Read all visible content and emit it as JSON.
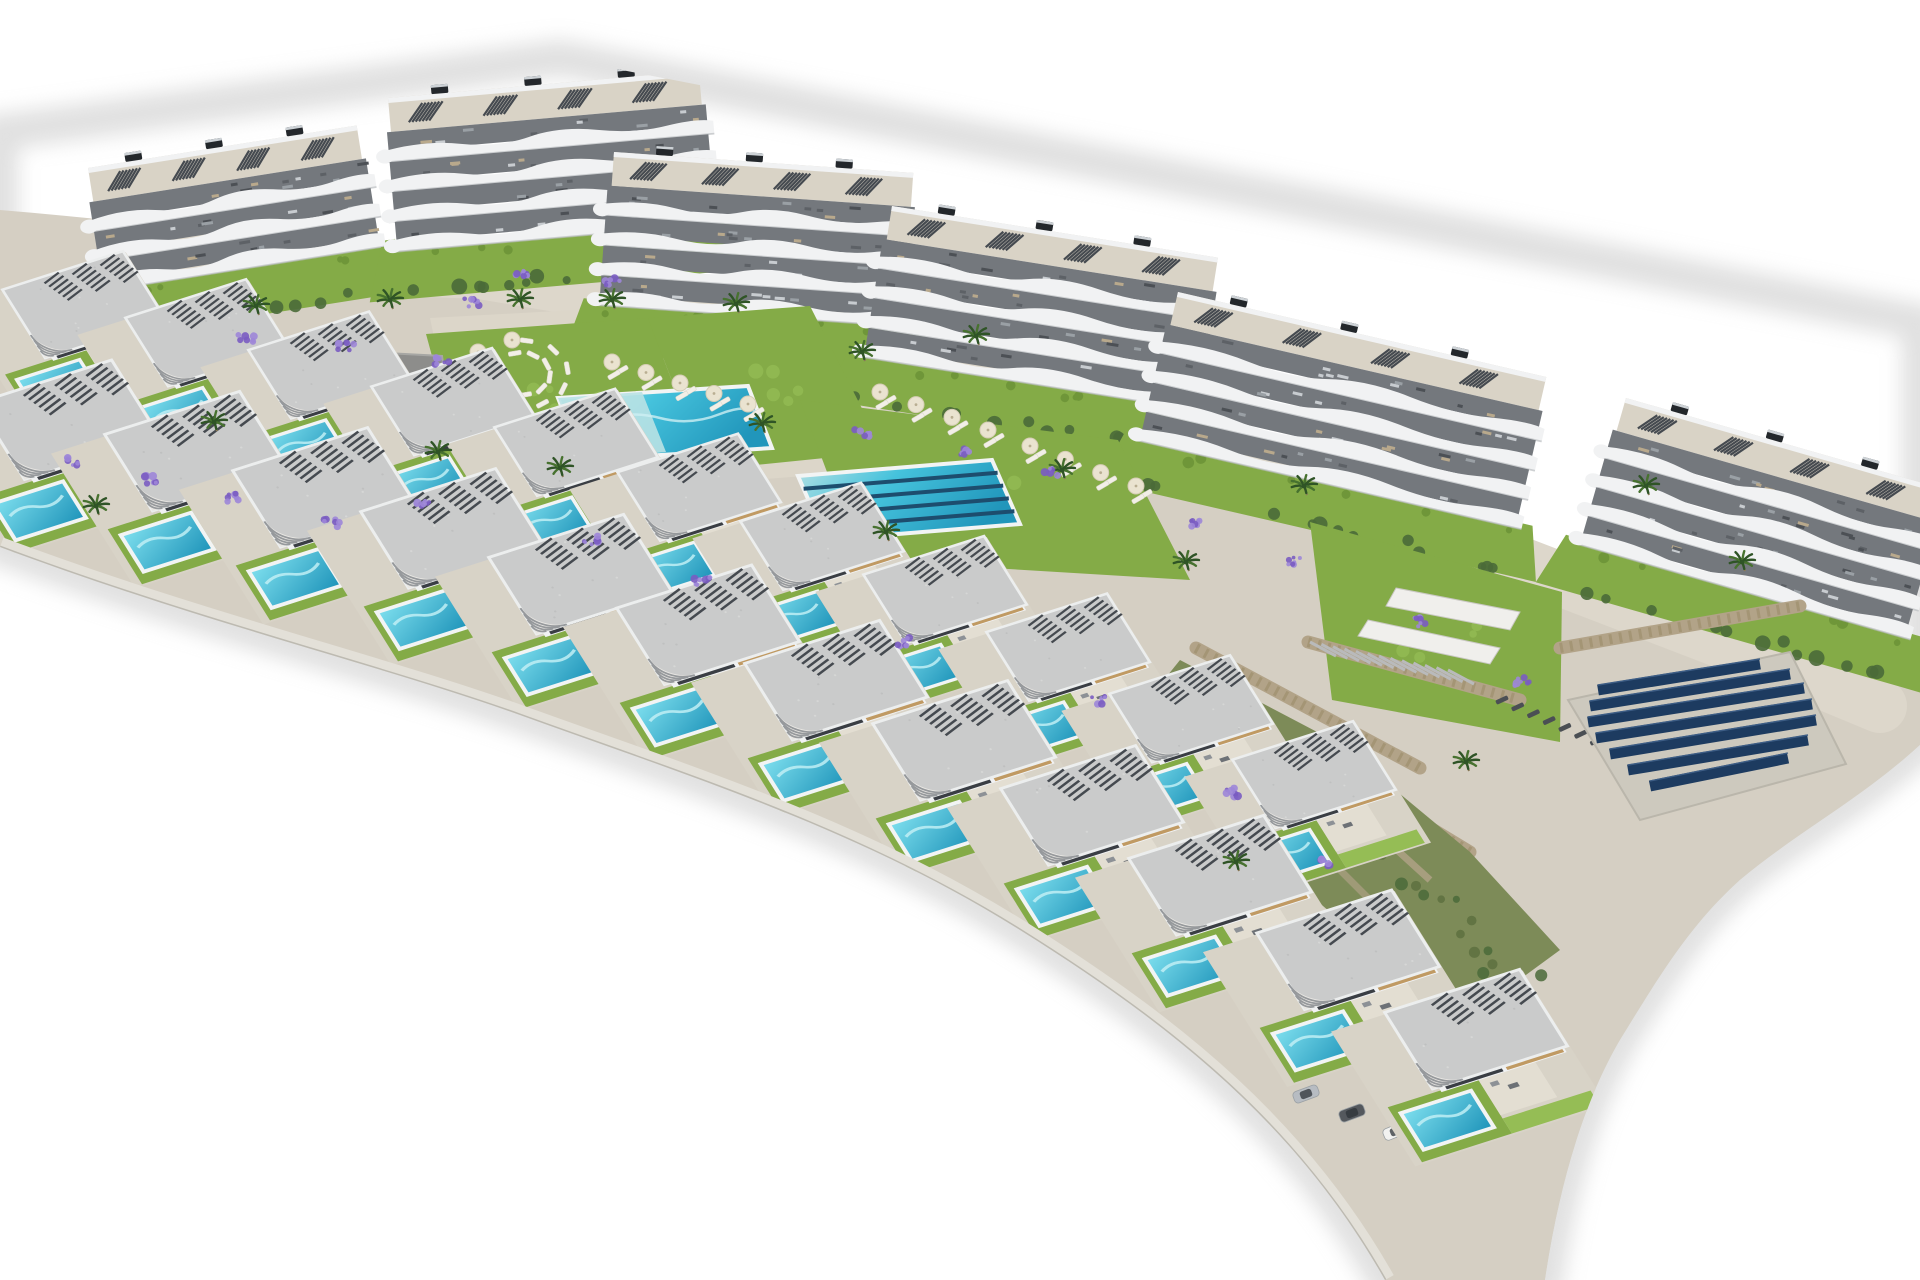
{
  "scene": {
    "alt_text": "Aerial 3D render of a hillside residential development: a curved row of six white terraced apartment blocks behind communal gardens with two turquoise pools, two stepped rows of modern villas each with a private pool, a playground, palm trees, lavender beds, stone retaining walls and a solar panel array, all on a white background",
    "counts": {
      "apartment_blocks": 6,
      "back_row_villas": 11,
      "front_row_villas": 12,
      "communal_pools": 2,
      "solar_panel_rows": 7,
      "cars": 7,
      "palm_trees": 20,
      "lavender_clusters": 24
    },
    "colors": {
      "bg": "#ffffff",
      "ground": "#d5cfc3",
      "promenade": "#ddd7cb",
      "sand": "#dcd6c9",
      "road": "#d2cec5",
      "lawn": "#84ab47",
      "lawn_light": "#95bd55",
      "lawn_dark": "#6f9639",
      "hedge": "#4a6a39",
      "pool_shallow": "#b9e2e4",
      "pool_mid": "#45c2dc",
      "pool_deep": "#2196bb",
      "pool_rim": "#f2f4f4",
      "lane": "#1d4d6e",
      "stone": "#b2a388",
      "stone_dark": "#93845f",
      "roof": "#cacbcb",
      "roof_fascia": "#e9e7e3",
      "slat": "#454a50",
      "beige": "#c09a63",
      "opening": "#3a3e44",
      "facade": "#f1f2f3",
      "balcony": "#74787d",
      "deck": "#d9d3c6",
      "solar": "#1d3b60",
      "solar_pad": "#cdc9be",
      "playground_pad": "#8d8d8b",
      "purple": "#7a5cc2",
      "purple_light": "#9d86d8",
      "palm": "#47722f",
      "palm_dark": "#2f5426",
      "trunk": "#8a7a58",
      "shadow": "#c2c2c2",
      "umbrella": "#eae3d0",
      "lounger": "#f2efe7",
      "lounger_dark": "#4b4f54"
    },
    "geometry": {
      "outline": "M0,132 L560,58 L1920,322 L1920,745 C1860,800 1800,830 1740,880 C1690,925 1660,975 1620,1040 C1585,1100 1560,1180 1545,1280 L1385,1280 C1300,1130 1180,1030 1020,930 C860,830 700,780 520,715 C380,665 200,622 0,547 Z",
      "ground_top": "M0,210 C350,240 700,295 1050,380 C1250,430 1450,510 1600,565 C1700,600 1850,640 1920,660 L1920,745 C1860,800 1800,830 1740,880 C1690,925 1660,975 1620,1040 C1585,1100 1560,1180 1545,1280 L1385,1280 C1300,1130 1180,1030 1020,930 C860,830 700,780 520,715 C380,665 200,622 0,547 Z",
      "bottom_edge": "M0,547 C200,622 380,665 520,715 C700,780 860,830 1020,930 C1180,1030 1300,1130 1385,1280",
      "promenade_pts": [
        [
          140,
          258
        ],
        [
          480,
          272
        ],
        [
          860,
          336
        ],
        [
          1200,
          438
        ],
        [
          1500,
          556
        ],
        [
          1740,
          648
        ],
        [
          1880,
          706
        ]
      ],
      "sand_pad": [
        [
          430,
          318
        ],
        [
          828,
          296
        ],
        [
          908,
          468
        ],
        [
          468,
          502
        ]
      ],
      "blocks": [
        {
          "x": 88,
          "y": 168,
          "w": 272,
          "floors": 3,
          "angle": -9
        },
        {
          "x": 388,
          "y": 98,
          "w": 312,
          "floors": 4,
          "angle": -5
        },
        {
          "x": 614,
          "y": 152,
          "w": 300,
          "floors": 4,
          "angle": 4
        },
        {
          "x": 892,
          "y": 206,
          "w": 330,
          "floors": 4,
          "angle": 9
        },
        {
          "x": 1178,
          "y": 292,
          "w": 378,
          "floors": 4,
          "angle": 13
        },
        {
          "x": 1626,
          "y": 398,
          "w": 330,
          "floors": 4,
          "angle": 16
        }
      ],
      "villa_rows": [
        {
          "name": "back",
          "count": 11,
          "sx": -34,
          "sy": 312,
          "dx": 123,
          "dy": 26,
          "acc": 2.1,
          "scale": 0.93
        },
        {
          "name": "front",
          "count": 12,
          "sx": -64,
          "sy": 428,
          "dx": 128,
          "dy": 29,
          "acc": 2.4,
          "scale": 1.04
        }
      ],
      "pools": {
        "main": {
          "pts": [
            [
              558,
              398
            ],
            [
              748,
              386
            ],
            [
              772,
              448
            ],
            [
              582,
              460
            ]
          ],
          "shallow": [
            [
              558,
              398
            ],
            [
              642,
              392
            ],
            [
              666,
              452
            ],
            [
              582,
              460
            ]
          ]
        },
        "lap": {
          "pts": [
            [
              798,
              476
            ],
            [
              992,
              460
            ],
            [
              1020,
              524
            ],
            [
              826,
              540
            ]
          ],
          "lanes": 4
        }
      },
      "lawns": [
        [
          [
            426,
            334
          ],
          [
            648,
            318
          ],
          [
            706,
            470
          ],
          [
            470,
            496
          ]
        ],
        [
          [
            648,
            318
          ],
          [
            810,
            306
          ],
          [
            884,
            452
          ],
          [
            706,
            470
          ]
        ],
        [
          [
            800,
            400
          ],
          [
            1118,
            440
          ],
          [
            1190,
            580
          ],
          [
            860,
            560
          ]
        ],
        [
          [
            1310,
            522
          ],
          [
            1562,
            592
          ],
          [
            1560,
            742
          ],
          [
            1332,
            700
          ]
        ],
        [
          [
            58,
            382
          ],
          [
            252,
            420
          ],
          [
            236,
            472
          ],
          [
            58,
            440
          ]
        ]
      ],
      "walls": [
        [
          [
            0,
            338
          ],
          [
            240,
            392
          ],
          [
            500,
            464
          ],
          [
            762,
            548
          ],
          [
            1022,
            644
          ],
          [
            1232,
            742
          ]
        ],
        [
          [
            60,
            472
          ],
          [
            350,
            522
          ],
          [
            700,
            588
          ],
          [
            1022,
            692
          ],
          [
            1242,
            782
          ]
        ],
        [
          [
            795,
            562
          ],
          [
            1040,
            652
          ]
        ],
        [
          [
            1308,
            642
          ],
          [
            1520,
            700
          ]
        ],
        [
          [
            1196,
            648
          ],
          [
            1420,
            768
          ]
        ],
        [
          [
            1262,
            726
          ],
          [
            1470,
            852
          ]
        ],
        [
          [
            1560,
            648
          ],
          [
            1800,
            606
          ]
        ]
      ],
      "playground": [
        [
          256,
          346
        ],
        [
          442,
          356
        ],
        [
          448,
          398
        ],
        [
          300,
          406
        ],
        [
          254,
          386
        ]
      ],
      "solar": {
        "pad": [
          [
            1568,
            700
          ],
          [
            1790,
            652
          ],
          [
            1846,
            764
          ],
          [
            1640,
            820
          ]
        ],
        "rows": [
          [
            1598,
            690,
            1760,
            664
          ],
          [
            1590,
            706,
            1790,
            674
          ],
          [
            1588,
            722,
            1804,
            688
          ],
          [
            1596,
            738,
            1812,
            704
          ],
          [
            1610,
            754,
            1816,
            720
          ],
          [
            1628,
            770,
            1808,
            740
          ],
          [
            1650,
            786,
            1788,
            758
          ]
        ]
      },
      "stairs": {
        "ramps": [
          [
            [
              1396,
              588
            ],
            [
              1520,
              612
            ],
            [
              1510,
              630
            ],
            [
              1386,
              606
            ]
          ],
          [
            [
              1368,
              620
            ],
            [
              1500,
              648
            ],
            [
              1490,
              664
            ],
            [
              1358,
              636
            ]
          ]
        ],
        "slats": {
          "x1": 1310,
          "y1": 642,
          "x2": 1448,
          "y2": 670,
          "n": 13
        }
      },
      "hillside": [
        [
          1180,
          660
        ],
        [
          1340,
          744
        ],
        [
          1470,
          852
        ],
        [
          1560,
          950
        ],
        [
          1470,
          1016
        ],
        [
          1330,
          912
        ],
        [
          1200,
          800
        ],
        [
          1130,
          722
        ]
      ],
      "road": {
        "pts": [
          [
            -10,
            455
          ],
          [
            250,
            512
          ],
          [
            520,
            600
          ],
          [
            790,
            700
          ],
          [
            1030,
            805
          ],
          [
            1230,
            905
          ],
          [
            1370,
            1000
          ],
          [
            1480,
            1090
          ]
        ],
        "width": 38
      },
      "cars": [
        {
          "x": 160,
          "y": 505,
          "r": -14,
          "c": "#f2f2ef"
        },
        {
          "x": 398,
          "y": 566,
          "r": -15,
          "c": "#e9ecee"
        },
        {
          "x": 648,
          "y": 650,
          "r": -16,
          "c": "#c6cacf"
        },
        {
          "x": 940,
          "y": 812,
          "r": -18,
          "c": "#f1f1ee"
        },
        {
          "x": 1306,
          "y": 1094,
          "r": -20,
          "c": "#b7bcc2"
        },
        {
          "x": 1352,
          "y": 1113,
          "r": -20,
          "c": "#54585d"
        },
        {
          "x": 1396,
          "y": 1131,
          "r": -22,
          "c": "#f2f2f0"
        }
      ],
      "palms": [
        [
          96,
          506
        ],
        [
          214,
          422
        ],
        [
          256,
          306
        ],
        [
          390,
          300
        ],
        [
          438,
          452
        ],
        [
          560,
          468
        ],
        [
          612,
          300
        ],
        [
          762,
          424
        ],
        [
          886,
          532
        ],
        [
          1062,
          470
        ],
        [
          1186,
          562
        ],
        [
          1304,
          486
        ],
        [
          1466,
          762
        ],
        [
          1236,
          862
        ],
        [
          976,
          336
        ],
        [
          1646,
          486
        ],
        [
          862,
          352
        ],
        [
          1742,
          562
        ],
        [
          736,
          304
        ],
        [
          520,
          300
        ]
      ],
      "lavender": [
        [
          70,
          462
        ],
        [
          150,
          480
        ],
        [
          232,
          498
        ],
        [
          332,
          523
        ],
        [
          246,
          338
        ],
        [
          346,
          346
        ],
        [
          442,
          360
        ],
        [
          472,
          302
        ],
        [
          522,
          272
        ],
        [
          612,
          282
        ],
        [
          862,
          432
        ],
        [
          962,
          452
        ],
        [
          1052,
          472
        ],
        [
          1192,
          522
        ],
        [
          1292,
          562
        ],
        [
          1422,
          622
        ],
        [
          1522,
          682
        ],
        [
          1232,
          792
        ],
        [
          1322,
          862
        ],
        [
          702,
          582
        ],
        [
          422,
          502
        ],
        [
          902,
          642
        ],
        [
          1100,
          700
        ],
        [
          592,
          540
        ]
      ],
      "lounger_fan": {
        "cx": 520,
        "cy": 374,
        "n": 12
      },
      "umbrella_rows": [
        {
          "x1": 612,
          "y1": 362,
          "x2": 748,
          "y2": 404,
          "n": 5
        },
        {
          "x1": 1030,
          "y1": 446,
          "x2": 1136,
          "y2": 486,
          "n": 4
        },
        {
          "x1": 880,
          "y1": 392,
          "x2": 988,
          "y2": 430,
          "n": 4
        }
      ],
      "dark_loungers": {
        "x1": 1502,
        "y1": 700,
        "x2": 1612,
        "y2": 748,
        "n": 8
      }
    }
  }
}
